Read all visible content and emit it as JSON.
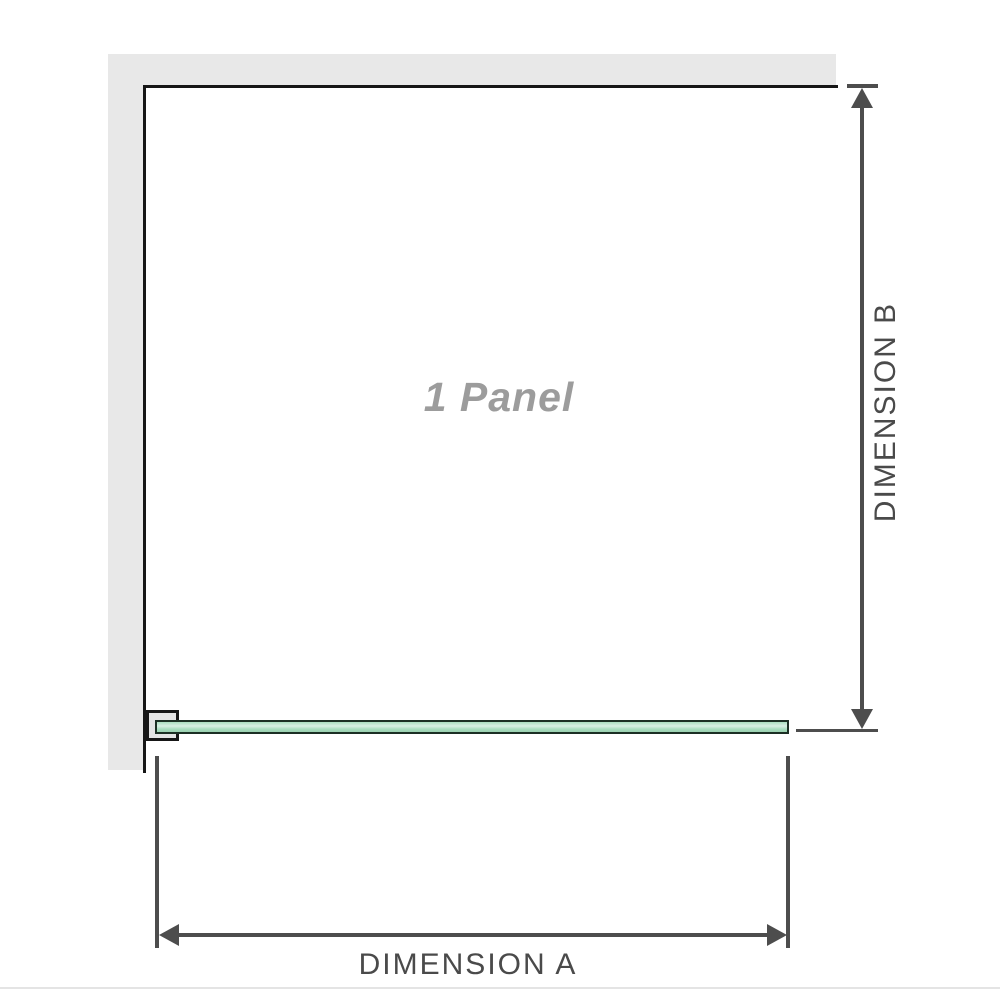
{
  "diagram": {
    "panel_label": "1 Panel",
    "dimension_a_label": "DIMENSION A",
    "dimension_b_label": "DIMENSION B"
  },
  "colors": {
    "wall_gray": "#e8e8e8",
    "outline_black": "#161616",
    "dimension_gray": "#4d4d4d",
    "label_gray": "#4a4a4a",
    "panel_text_gray": "#9c9c9c",
    "glass_green": "#aaddc0",
    "glass_green_light": "#d9efe3",
    "glass_green_dark": "#9bd1b1",
    "glass_border": "#1c2f24",
    "bracket_fill": "#e4e4e4",
    "footer_rule": "#e4e4e4"
  }
}
